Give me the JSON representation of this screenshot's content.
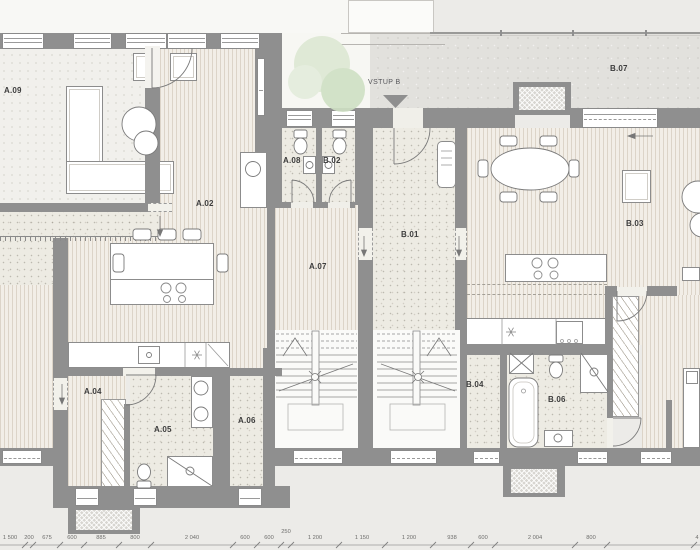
{
  "plan": {
    "entrance_label": "VSTUP B",
    "rooms": [
      {
        "id": "a09",
        "label": "A.09",
        "x": 4,
        "y": 87
      },
      {
        "id": "a02",
        "label": "A.02",
        "x": 196,
        "y": 200
      },
      {
        "id": "a08",
        "label": "A.08",
        "x": 283,
        "y": 157
      },
      {
        "id": "b02",
        "label": "B.02",
        "x": 323,
        "y": 157
      },
      {
        "id": "b07",
        "label": "B.07",
        "x": 610,
        "y": 65
      },
      {
        "id": "b01",
        "label": "B.01",
        "x": 401,
        "y": 231
      },
      {
        "id": "a07",
        "label": "A.07",
        "x": 309,
        "y": 263
      },
      {
        "id": "b03",
        "label": "B.03",
        "x": 626,
        "y": 220
      },
      {
        "id": "a04",
        "label": "A.04",
        "x": 84,
        "y": 388
      },
      {
        "id": "a05",
        "label": "A.05",
        "x": 154,
        "y": 426
      },
      {
        "id": "a06",
        "label": "A.06",
        "x": 238,
        "y": 417
      },
      {
        "id": "b04",
        "label": "B.04",
        "x": 466,
        "y": 381
      },
      {
        "id": "b06",
        "label": "B.06",
        "x": 548,
        "y": 396
      }
    ],
    "dimensions": {
      "labels": [
        {
          "t": "1 500",
          "x": 10
        },
        {
          "t": "200",
          "x": 29
        },
        {
          "t": "675",
          "x": 47
        },
        {
          "t": "600",
          "x": 72
        },
        {
          "t": "885",
          "x": 101
        },
        {
          "t": "800",
          "x": 135
        },
        {
          "t": "2 040",
          "x": 192
        },
        {
          "t": "600",
          "x": 245
        },
        {
          "t": "600",
          "x": 269
        },
        {
          "t": "250",
          "x": 286,
          "r": 1
        },
        {
          "t": "1 200",
          "x": 315
        },
        {
          "t": "1 150",
          "x": 362
        },
        {
          "t": "1 200",
          "x": 409
        },
        {
          "t": "938",
          "x": 452
        },
        {
          "t": "600",
          "x": 483
        },
        {
          "t": "2 004",
          "x": 535
        },
        {
          "t": "800",
          "x": 591
        },
        {
          "t": "4",
          "x": 697
        }
      ],
      "ticks": [
        25,
        33,
        60,
        84,
        119,
        151,
        233,
        257,
        281,
        291,
        339,
        385,
        433,
        471,
        495,
        575,
        607,
        694
      ]
    },
    "colors": {
      "wall": "#8f8f8f",
      "wood_floor": "#f2eee7",
      "bath_floor": "#edebe3",
      "terrace": "#e2e1dd",
      "tree_green": "#d9e6cf",
      "paper": "#ecebe8"
    }
  }
}
